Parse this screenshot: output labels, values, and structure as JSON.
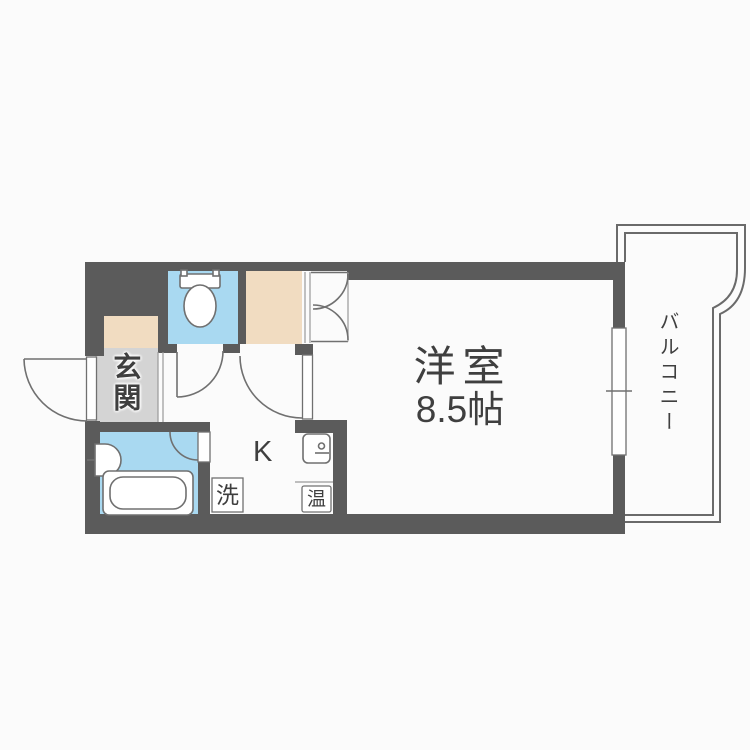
{
  "colors": {
    "background": "#fbfbfb",
    "wall": "#5b5b5b",
    "line": "#707070",
    "line_light": "#9a9a9a",
    "toilet_blue": "#a9d9f1",
    "bath_blue": "#a9d9f1",
    "closet_beige": "#f1dcc1",
    "entrance_gray": "#d4d4d4",
    "text": "#3f3f3f"
  },
  "rooms": {
    "main_room": {
      "name_label": "洋室",
      "size_label": "8.5帖"
    },
    "kitchen": {
      "label": "K"
    },
    "entrance": {
      "label": "玄関"
    },
    "balcony": {
      "label": "バルコニー"
    }
  },
  "fixtures": {
    "washing_machine_label": "洗",
    "water_heater_label": "温"
  }
}
